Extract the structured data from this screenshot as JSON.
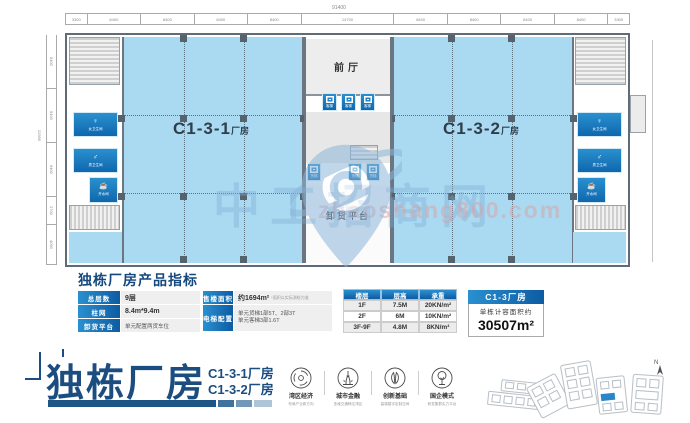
{
  "watermark": {
    "site_name": "中工招商网",
    "site_url": "zhaoshang800.com"
  },
  "plan": {
    "dims_top_total": "91400",
    "dims_top": [
      "3300",
      "8400",
      "8400",
      "8400",
      "8400",
      "14700",
      "8400",
      "8400",
      "8400",
      "8400",
      "3300"
    ],
    "dims_left": [
      "5400",
      "5400",
      "5400",
      "2700",
      "4050"
    ],
    "dims_left_total": "22950",
    "hall_left": {
      "code": "C1-3-1",
      "suffix": "厂房"
    },
    "hall_right": {
      "code": "C1-3-2",
      "suffix": "厂房"
    },
    "front_hall": "前厅",
    "unloading": "卸货平台",
    "wc_women": "女卫生间",
    "wc_men": "男卫生间",
    "water_room": "开水间",
    "passenger_lift": "客梯",
    "freight_lift": "货梯"
  },
  "indicators": {
    "title": "独栋厂房产品指标",
    "left_table": [
      {
        "label": "总层数",
        "value": "9层"
      },
      {
        "label": "柱网",
        "value": "8.4m*9.4m"
      },
      {
        "label": "卸货平台",
        "value": "单元配置两货车位"
      }
    ],
    "mid_table": {
      "area_label": "售楼面积",
      "area_value": "约1694m²",
      "area_note": "*面积以实际测绘为准",
      "lift_label": "电梯配置",
      "lift_line1": "单元货梯1部5T、2部3T",
      "lift_line2": "单元客梯3部1.6T"
    },
    "floor_table": {
      "headers": [
        "楼层",
        "层高",
        "承重"
      ],
      "rows": [
        [
          "1F",
          "7.5M",
          "20KN/m²"
        ],
        [
          "2F",
          "6M",
          "10KN/m²"
        ],
        [
          "3F-9F",
          "4.8M",
          "8KN/m²"
        ]
      ]
    },
    "area_card": {
      "title": "C1-3厂房",
      "label": "单栋计容面积约",
      "value": "30507m²"
    }
  },
  "footer": {
    "main_title": "独栋厂房",
    "sub_title_1": "C1-3-1厂房",
    "sub_title_2": "C1-3-2厂房",
    "features": [
      {
        "name": "湾区经济",
        "desc": "布局产业新方向"
      },
      {
        "name": "城市金融",
        "desc": "多维交通畅达湾区"
      },
      {
        "name": "创新基础",
        "desc": "高端楼宇定制空间"
      },
      {
        "name": "国企模式",
        "desc": "研发集群实力平台"
      }
    ],
    "north_label": "N"
  },
  "colors": {
    "accent_blue": "#1b80c4",
    "navy": "#1c4d80",
    "hall_fill": "#a9daf2",
    "wall_gray": "#6b7680"
  }
}
